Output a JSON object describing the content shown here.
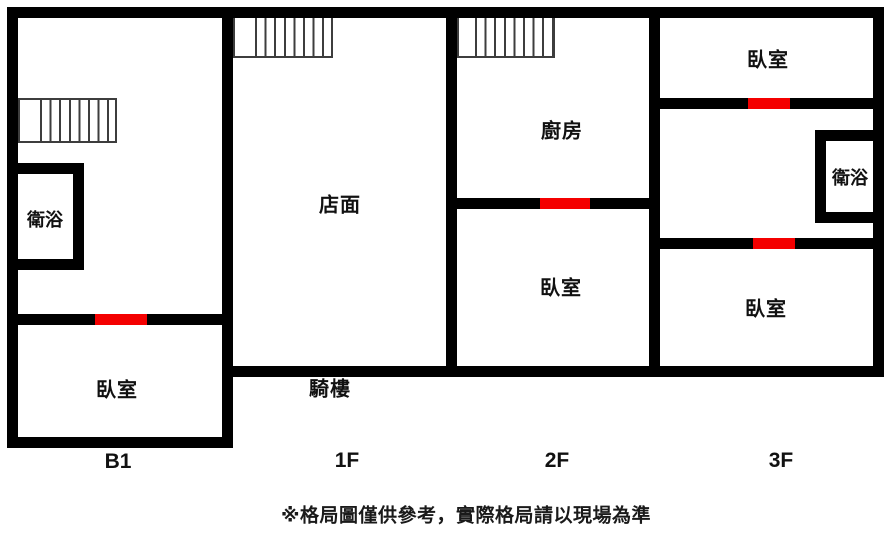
{
  "title": "多樓層住宅格局圖",
  "disclaimer": "※格局圖僅供參考，實際格局請以現場為準",
  "colors": {
    "wall": "#000000",
    "door_marker": "#f40000",
    "stair_line": "#3d3d3d",
    "background": "#ffffff",
    "text": "#111111"
  },
  "floors": [
    {
      "label": "B1",
      "rooms": [
        {
          "name": "衛浴"
        },
        {
          "name": "臥室"
        }
      ],
      "staircases": 1,
      "door_markers": 1
    },
    {
      "label": "1F",
      "rooms": [
        {
          "name": "店面"
        },
        {
          "name": "騎樓"
        }
      ],
      "staircases": 1,
      "door_markers": 0
    },
    {
      "label": "2F",
      "rooms": [
        {
          "name": "廚房"
        },
        {
          "name": "臥室"
        }
      ],
      "staircases": 1,
      "door_markers": 1
    },
    {
      "label": "3F",
      "rooms": [
        {
          "name": "臥室"
        },
        {
          "name": "衛浴"
        },
        {
          "name": "臥室"
        }
      ],
      "staircases": 0,
      "door_markers": 2
    }
  ]
}
